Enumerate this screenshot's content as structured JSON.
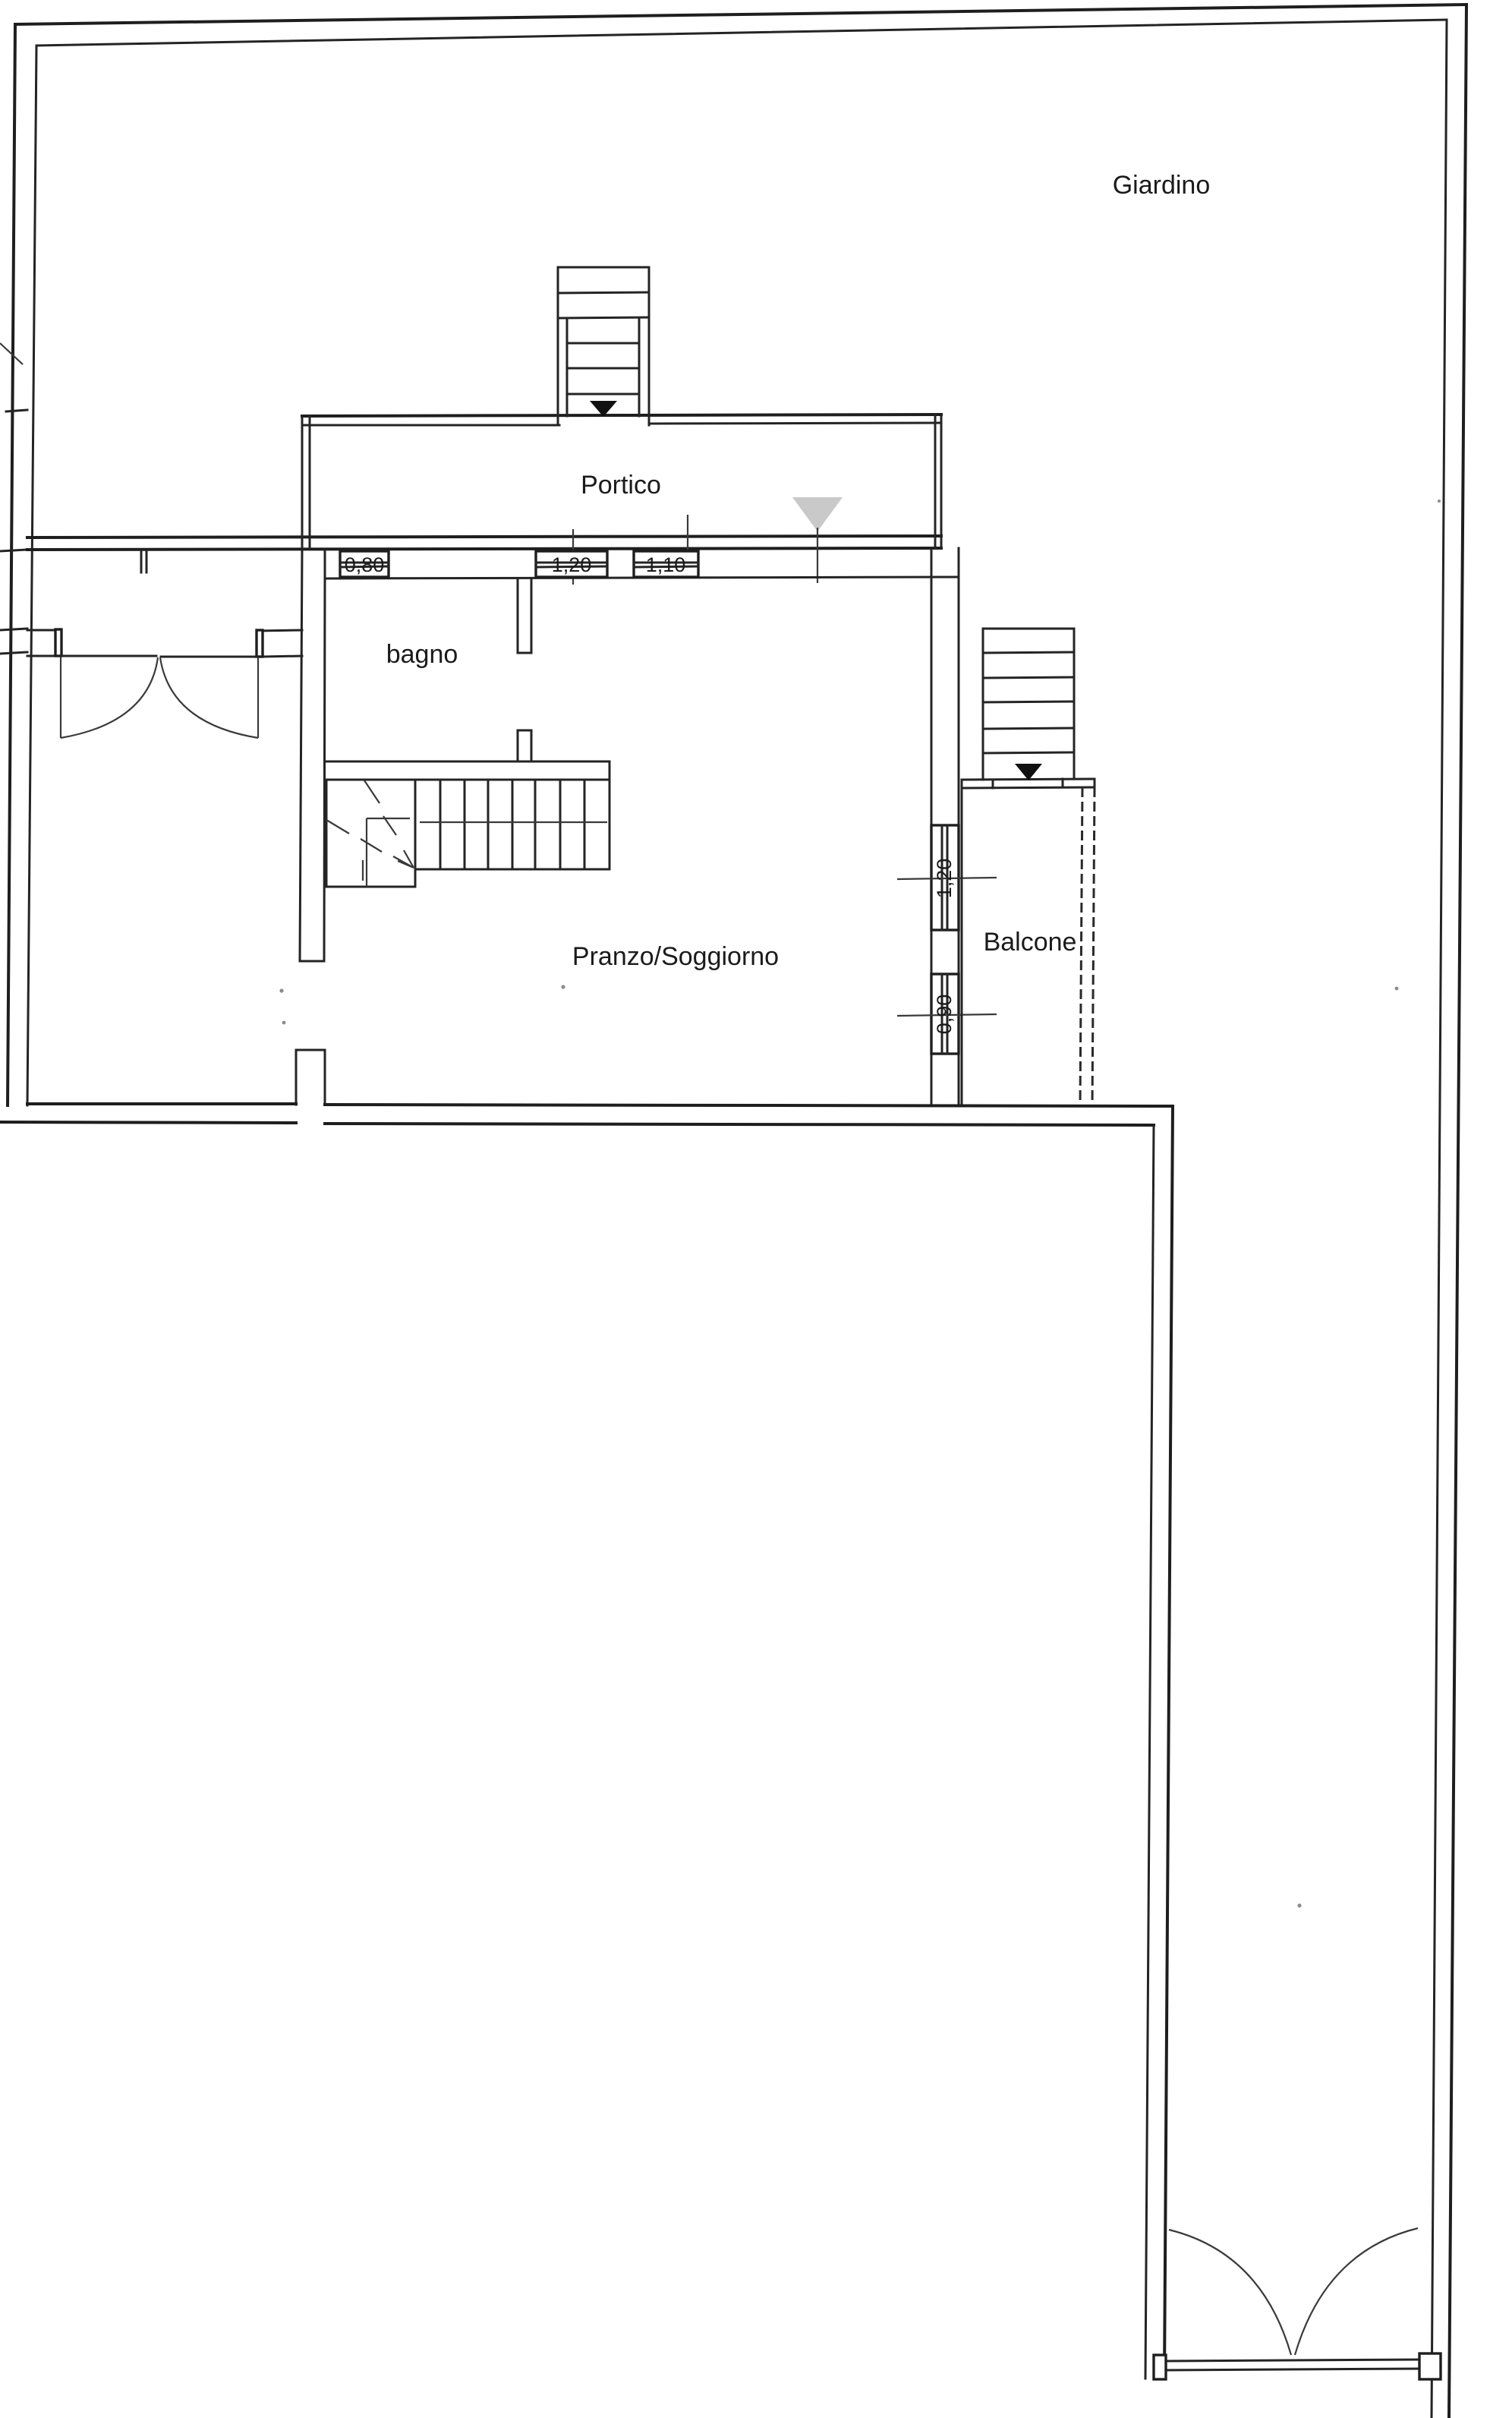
{
  "plan": {
    "title_hint": "floor-plan",
    "labels": {
      "garden": "Giardino",
      "porch": "Portico",
      "bathroom": "bagno",
      "living_dining": "Pranzo/Soggiorno",
      "balcony": "Balcone"
    },
    "dimensions": {
      "bath_window": "0,80",
      "north_window_large": "1,20",
      "north_window_small": "1,10",
      "east_french_door": "1,20",
      "east_window": "0,90"
    },
    "colors": {
      "ink": "#1e1e1e",
      "paper": "#ffffff",
      "entrance_marker": "#c9c9c9"
    }
  }
}
